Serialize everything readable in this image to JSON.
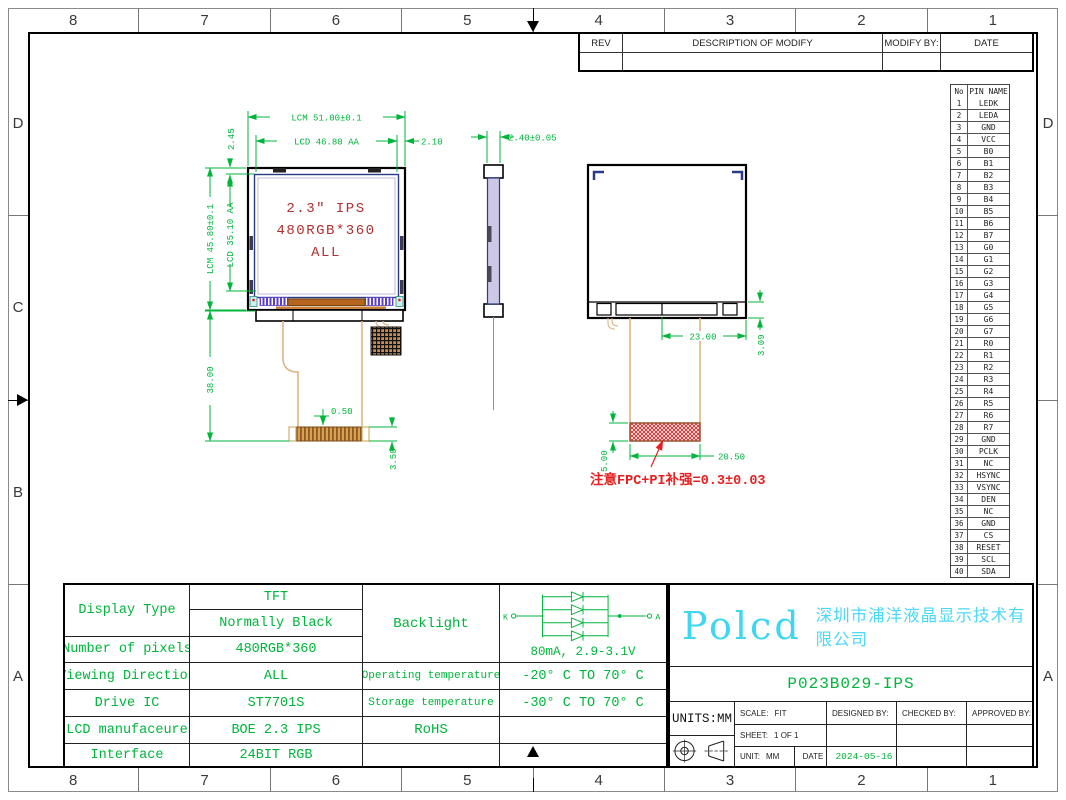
{
  "colors": {
    "dimension_green": "#00b43c",
    "screen_red": "#b03030",
    "note_red": "#e62020",
    "logo_cyan": "#3fd6f2",
    "panel_navy": "#2a3c85",
    "fpc_orange": "#dcb684"
  },
  "sheet": {
    "zones": {
      "columns": [
        "8",
        "7",
        "6",
        "5",
        "4",
        "3",
        "2",
        "1"
      ],
      "rows_left": [
        "D",
        "C",
        "B",
        "A"
      ],
      "rows_right": [
        "D",
        "",
        "",
        "A"
      ]
    }
  },
  "rev_table": {
    "headers": [
      "REV",
      "DESCRIPTION OF MODIFY",
      "MODIFY BY:",
      "DATE"
    ],
    "row": [
      "",
      "",
      "",
      ""
    ]
  },
  "pin_table": {
    "no_header": "No",
    "name_header": "PIN NAME",
    "pins": [
      "LEDK",
      "LEDA",
      "GND",
      "VCC",
      "B0",
      "B1",
      "B2",
      "B3",
      "B4",
      "B5",
      "B6",
      "B7",
      "G0",
      "G1",
      "G2",
      "G3",
      "G4",
      "G5",
      "G6",
      "G7",
      "R0",
      "R1",
      "R2",
      "R3",
      "R4",
      "R5",
      "R6",
      "R7",
      "GND",
      "PCLK",
      "NC",
      "HSYNC",
      "VSYNC",
      "DEN",
      "NC",
      "GND",
      "CS",
      "RESET",
      "SCL",
      "SDA"
    ]
  },
  "drawing": {
    "front": {
      "screen_lines": [
        "2.3″ IPS",
        "480RGB*360",
        "ALL"
      ],
      "dim_lcm_width": "LCM 51.00±0.1",
      "dim_lcd_width": "LCD 46.80 AA",
      "dim_right_margin": "2.10",
      "dim_top_margin": "2.45",
      "dim_lcm_height": "LCM 45.80±0.1",
      "dim_lcd_height": "LCD 35.10 AA",
      "dim_fpc_length": "38.00",
      "dim_tail_offset": "0.50",
      "dim_tail_height": "3.50"
    },
    "side": {
      "dim_thickness": "2.40±0.05"
    },
    "rear": {
      "dim_connector_width": "23.00",
      "dim_bottom_height": "3.09",
      "dim_stiffener_height": "5.00",
      "dim_stiffener_width": "20.50",
      "note": "注意FPC+PI补强=0.3±0.03"
    }
  },
  "spec_table": {
    "display_type_label": "Display Type",
    "display_type_value1": "TFT",
    "display_type_value2": "Normally Black",
    "pixels_label": "Number of pixels",
    "pixels_value": "480RGB*360",
    "viewing_label": "Viewing Direction",
    "viewing_value": "ALL",
    "drive_ic_label": "Drive IC",
    "drive_ic_value": "ST7701S",
    "manufacturer_label": "LCD manufaceure",
    "manufacturer_value": "BOE 2.3 IPS",
    "interface_label": "Interface",
    "interface_value": "24BIT RGB",
    "backlight_label": "Backlight",
    "backlight_value": "80mA, 2.9-3.1V",
    "backlight_k": "K",
    "backlight_a": "A",
    "op_temp_label": "Operating temperature",
    "op_temp_value": "-20° C TO 70° C",
    "st_temp_label": "Storage temperature",
    "st_temp_value": "-30° C TO 70° C",
    "rohs_label": "RoHS"
  },
  "title_block": {
    "logo": "Polcd",
    "company": "深圳市浦洋液晶显示技术有限公司",
    "part_number": "P023B029-IPS",
    "units": "UNITS:MM",
    "scale_label": "SCALE:",
    "scale_value": "FIT",
    "designed_label": "DESIGNED BY:",
    "checked_label": "CHECKED BY:",
    "approved_label": "APPROVED BY:",
    "sheet_label": "SHEET:",
    "sheet_value": "1 OF 1",
    "unit_label": "UNIT:",
    "unit_value": "MM",
    "date_label": "DATE",
    "date_value": "2024-05-16"
  }
}
